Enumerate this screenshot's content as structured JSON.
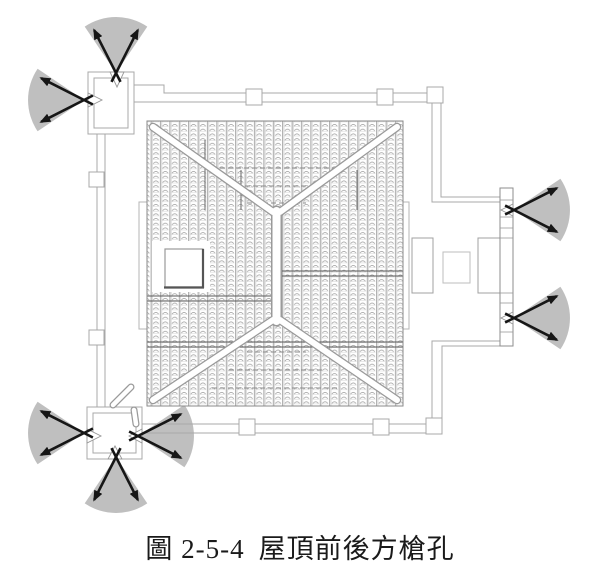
{
  "figure": {
    "caption_label": "圖 2-5-4",
    "caption_title": "屋頂前後方槍孔",
    "caption": "圖 2-5-4 屋頂前後方槍孔"
  },
  "colors": {
    "fan": "#bfbfbf",
    "arrow": "#161616",
    "background": "#ffffff"
  },
  "fan_style": {
    "radius": 56,
    "half_angle": 34,
    "arrow_angle": 27,
    "arrow_length": 48,
    "tail": 10,
    "arrow_width": 2.6
  },
  "gun_ports": [
    {
      "location": "northwest-bastion-north-port",
      "x": 116,
      "y": 73,
      "dir": 270
    },
    {
      "location": "northwest-bastion-west-port",
      "x": 84,
      "y": 100,
      "dir": 180
    },
    {
      "location": "east-porch-north-port",
      "x": 514,
      "y": 210,
      "dir": 0
    },
    {
      "location": "east-porch-south-port",
      "x": 514,
      "y": 318,
      "dir": 0
    },
    {
      "location": "southwest-bastion-west-port",
      "x": 84,
      "y": 433,
      "dir": 180
    },
    {
      "location": "southwest-bastion-south-port",
      "x": 116,
      "y": 457,
      "dir": 90
    },
    {
      "location": "southwest-bastion-east-port",
      "x": 138,
      "y": 436,
      "dir": 0
    }
  ]
}
